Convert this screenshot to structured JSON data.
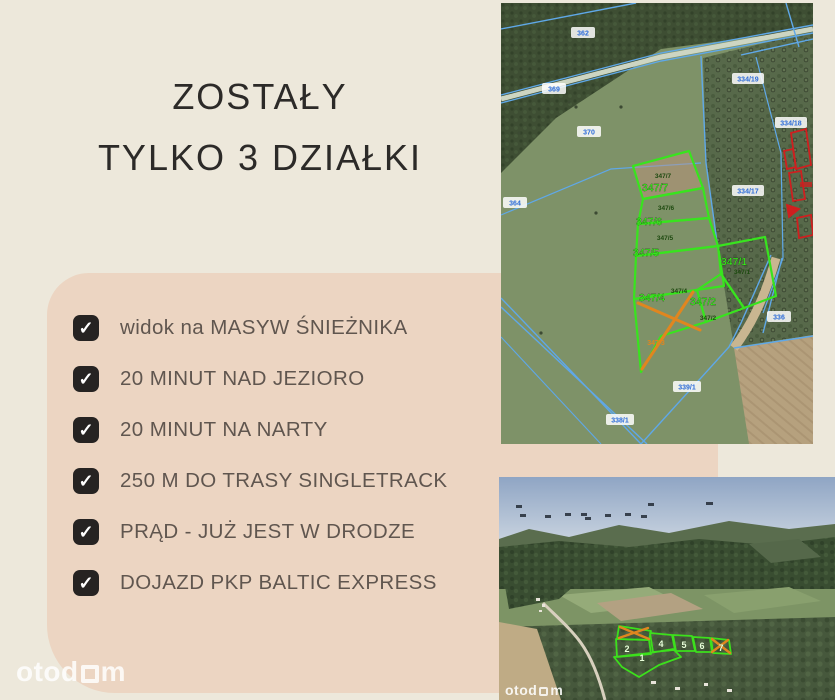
{
  "headline": {
    "line1": "ZOSTAŁY",
    "line2": "TYLKO 3 DZIAŁKI"
  },
  "features": {
    "checkbox_glyph": "✓",
    "items": [
      "widok na MASYW ŚNIEŻNIKA",
      "20 MINUT NAD JEZIORO",
      "20 MINUT NA NARTY",
      "250 M DO TRASY SINGLETRACK",
      "PRĄD - JUŻ JEST W DRODZE",
      "DOJAZD PKP BALTIC EXPRESS"
    ]
  },
  "brand": {
    "name": "otodom",
    "wordmark_prefix": "otod",
    "wordmark_suffix": "m"
  },
  "colors": {
    "page_bg": "#EDE8DB",
    "card_bg": "#ECD5C2",
    "checkbox": "#262322",
    "headline_text": "#2C2A28",
    "feature_text": "#60564F",
    "parcel_green": "#38E41E",
    "cadastral_blue": "#5FA8E8",
    "sold_orange": "#E0861F",
    "building_red": "#CF1F1F"
  },
  "top_map": {
    "plots": [
      {
        "id": "347/7"
      },
      {
        "id": "347/6"
      },
      {
        "id": "347/5"
      },
      {
        "id": "347/4"
      },
      {
        "id": "347/1"
      },
      {
        "id": "347/2"
      }
    ],
    "sold_plot": {
      "id": "347/3"
    },
    "cadastral_labels": [
      {
        "text": "362"
      },
      {
        "text": "369"
      },
      {
        "text": "370"
      },
      {
        "text": "364"
      },
      {
        "text": "334/19"
      },
      {
        "text": "334/18"
      },
      {
        "text": "334/17"
      },
      {
        "text": "336"
      },
      {
        "text": "339/1"
      },
      {
        "text": "338/1"
      }
    ]
  },
  "bottom_map": {
    "plot_numbers": [
      {
        "n": "2"
      },
      {
        "n": "4"
      },
      {
        "n": "5"
      },
      {
        "n": "6"
      },
      {
        "n": "7"
      },
      {
        "n": "1"
      }
    ],
    "crossed_out_marks": 2
  }
}
